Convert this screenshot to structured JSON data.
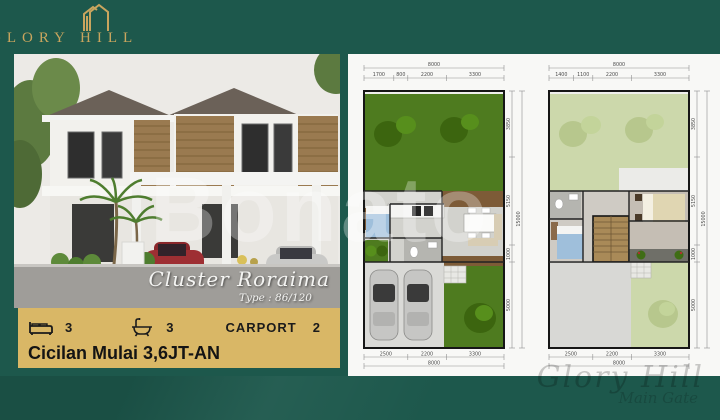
{
  "colors": {
    "background_green": "#1d584c",
    "gold_accent": "#c9a55e",
    "banner_gold": "#d9b766",
    "plan_panel": "#f8f8f6",
    "grass_green": "#4e7b1f",
    "roof_garden_pale": "#ccd8ab"
  },
  "logo": {
    "brand": "GLORY HILL"
  },
  "photo": {
    "cluster_name": "Cluster Roraima",
    "type_label": "Type : 86/120"
  },
  "banner": {
    "bed_count": "3",
    "bath_count": "3",
    "carport_label": "CARPORT",
    "carport_count": "2",
    "installment": "Cicilan Mulai 3,6JT-AN"
  },
  "watermark": {
    "center": "Bonato",
    "corner_script": "Glory Hill",
    "corner_sub": "Main Gate"
  },
  "floorplans": [
    {
      "name": "first-floor",
      "dims_top_total": "8000",
      "dims_top": [
        "1700",
        "800",
        "2200",
        "3300"
      ],
      "dims_bottom": [
        "2500",
        "2200",
        "3300"
      ],
      "dims_bottom_total": "8000",
      "dims_right": [
        "3850",
        "5150",
        "1000",
        "5000"
      ],
      "dims_right_total": "15000"
    },
    {
      "name": "second-floor",
      "dims_top_total": "8000",
      "dims_top": [
        "1400",
        "1100",
        "2200",
        "3300"
      ],
      "dims_bottom": [
        "2500",
        "2200",
        "3300"
      ],
      "dims_bottom_total": "8000",
      "dims_right": [
        "3850",
        "5150",
        "1000",
        "5000"
      ],
      "dims_right_total": "15000"
    }
  ]
}
